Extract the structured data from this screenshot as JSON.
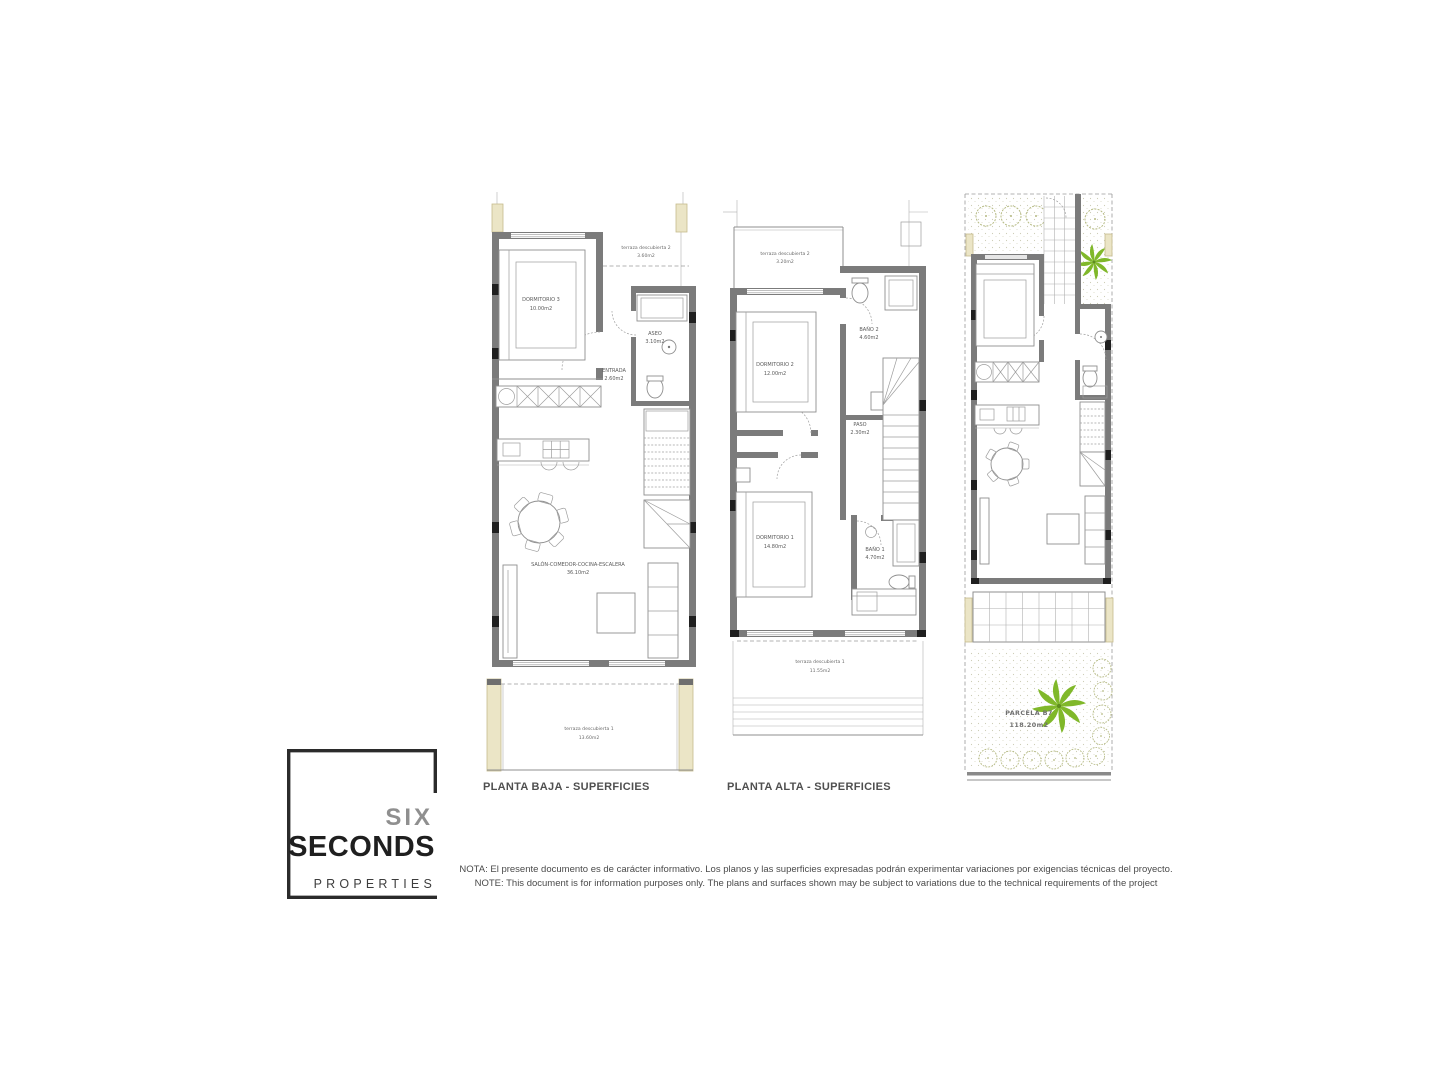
{
  "colors": {
    "wall_gray": "#7b7b7b",
    "pillar_beige": "#ebe5c6",
    "plant_green": "#80b82a",
    "tree_olive": "#b5ba82"
  },
  "plans": {
    "baja": {
      "title": "PLANTA BAJA - SUPERFICIES",
      "rooms": {
        "dormitorio3": {
          "name": "DORMITORIO 3",
          "area": "10.00m2"
        },
        "terraza2": {
          "name": "terraza descubierta 2",
          "area": "3.60m2"
        },
        "aseo": {
          "name": "ASEO",
          "area": "3.10m2"
        },
        "entrada": {
          "name": "ENTRADA",
          "area": "2.60m2"
        },
        "salon": {
          "name": "SALÓN-COMEDOR-COCINA-ESCALERA",
          "area": "36.10m2"
        },
        "terraza1": {
          "name": "terraza descubierta 1",
          "area": "13.60m2"
        }
      }
    },
    "alta": {
      "title": "PLANTA ALTA - SUPERFICIES",
      "rooms": {
        "terraza2": {
          "name": "terraza descubierta 2",
          "area": "3.20m2"
        },
        "dormitorio2": {
          "name": "DORMITORIO 2",
          "area": "12.00m2"
        },
        "bano2": {
          "name": "BAÑO 2",
          "area": "4.60m2"
        },
        "paso": {
          "name": "PASO",
          "area": "2.30m2"
        },
        "dormitorio1": {
          "name": "DORMITORIO 1",
          "area": "14.80m2"
        },
        "bano1": {
          "name": "BAÑO 1",
          "area": "4.70m2"
        },
        "terraza1": {
          "name": "terraza descubierta 1",
          "area": "11.55m2"
        }
      }
    },
    "parcela": {
      "label": {
        "name": "PARCELA B7",
        "area": "118.20m2"
      }
    }
  },
  "logo": {
    "top": "SIX",
    "middle": "SECONDS",
    "bottom": "PROPERTIES"
  },
  "disclaimer": {
    "es": "NOTA: El presente documento es de carácter informativo. Los planos y las superficies expresadas podrán experimentar variaciones por exigencias técnicas del proyecto.",
    "en": "NOTE: This document is for information purposes only. The plans and surfaces shown may be subject to variations due to the technical requirements of the project"
  }
}
